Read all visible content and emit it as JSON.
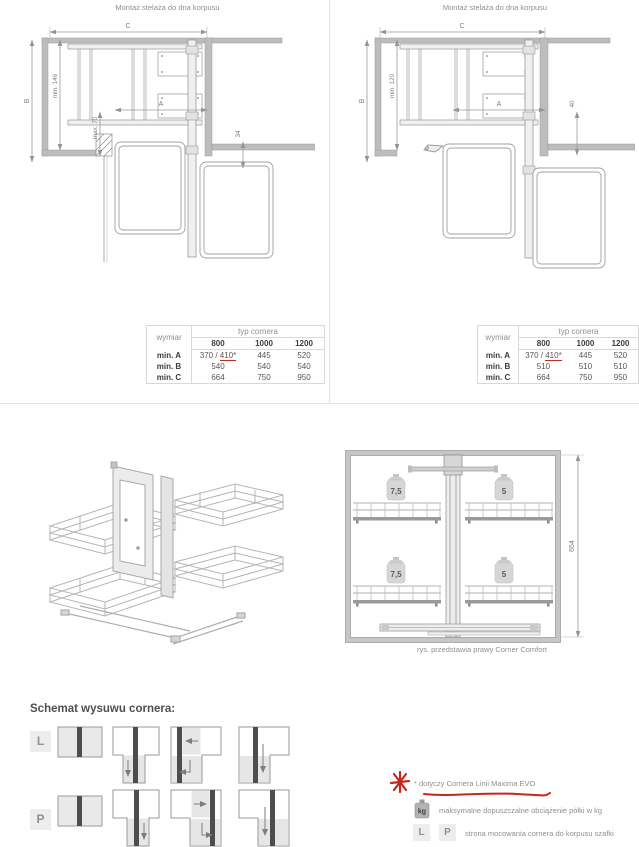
{
  "panels": [
    {
      "title": "Montaż stelaża do dna korpusu",
      "dims": {
        "c": "C",
        "b": "B",
        "a": "A",
        "inner1": "min. 146",
        "inner2": "max. 70",
        "front": "34"
      },
      "table": {
        "corner": "wymiar",
        "group": "typ cornera",
        "cols": [
          "800",
          "1000",
          "1200"
        ],
        "rowA": {
          "label": "min. A",
          "v1_plain": "370 / ",
          "v1_marked": "410*",
          "v2": "445",
          "v3": "520"
        },
        "rowB": {
          "label": "min. B",
          "v1": "540",
          "v2": "540",
          "v3": "540"
        },
        "rowC": {
          "label": "min. C",
          "v1": "664",
          "v2": "750",
          "v3": "950"
        }
      }
    },
    {
      "title": "Montaż stelaża do dna korpusu",
      "dims": {
        "c": "C",
        "b": "B",
        "a": "A",
        "inner1": "min. 120",
        "front": "40"
      },
      "table": {
        "corner": "wymiar",
        "group": "typ cornera",
        "cols": [
          "800",
          "1000",
          "1200"
        ],
        "rowA": {
          "label": "min. A",
          "v1_plain": "370 / ",
          "v1_marked": "410*",
          "v2": "445",
          "v3": "520"
        },
        "rowB": {
          "label": "min. B",
          "v1": "510",
          "v2": "510",
          "v3": "510"
        },
        "rowC": {
          "label": "min. C",
          "v1": "664",
          "v2": "750",
          "v3": "950"
        }
      }
    }
  ],
  "front_view": {
    "loads": {
      "top_left": "7,5",
      "top_right": "5",
      "bottom_left": "7,5",
      "bottom_right": "5"
    },
    "height_dim": "654",
    "caption": "rys. przedstawia prawy Corner Comfort"
  },
  "schemat": {
    "heading": "Schemat wysuwu cornera:",
    "left_label": "L",
    "right_label": "P"
  },
  "legend": {
    "note": "* dotyczy Cornera Linii Maxima EVO",
    "kg_badge": "kg",
    "kg_text": "maksymalne dopuszczalne obciążenie półki w kg",
    "l_badge": "L",
    "p_badge": "P",
    "lp_text": "strona mocowania cornera do korpusu szafki"
  },
  "colors": {
    "accent_red": "#c6281c",
    "wall_gray": "#bdbdbd",
    "line_gray": "#a0a0a0",
    "text_gray": "#8f8f8f"
  }
}
